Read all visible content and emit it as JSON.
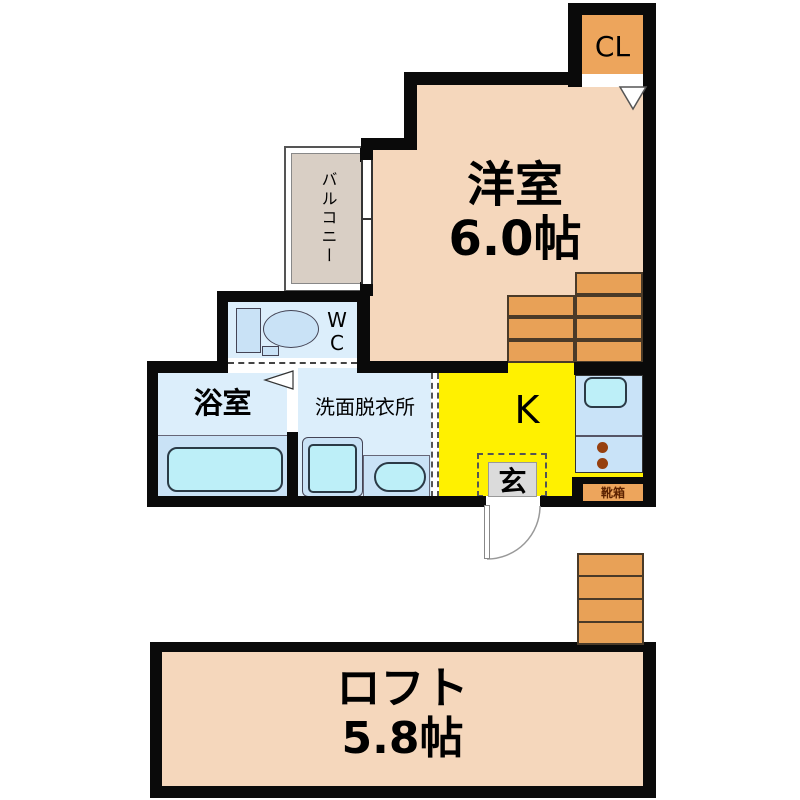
{
  "floorplan": {
    "closet": {
      "label": "CL"
    },
    "main_room": {
      "name": "洋室",
      "area": "6.0帖"
    },
    "balcony": {
      "label": "バルコニー"
    },
    "toilet_room": {
      "lines": [
        "W",
        "C"
      ]
    },
    "bathroom": {
      "label": "浴室"
    },
    "washroom": {
      "label": "洗面脱衣所"
    },
    "kitchen": {
      "label": "K"
    },
    "entrance": {
      "label": "玄"
    },
    "shoe_cabinet": {
      "label": "靴箱"
    },
    "loft": {
      "name": "ロフト",
      "area": "5.8帖"
    },
    "colors": {
      "wall": "#0a0a0a",
      "room_peach": "#F5D7BC",
      "closet_orange": "#EDA55C",
      "stairs_orange": "#E8A157",
      "kitchen_yellow": "#FFF100",
      "room_blue": "#DCEEFB",
      "fixture_blue": "#C9E2F6",
      "fixture_cyan": "#BDEFF8",
      "balcony_gray": "#D9CFC5",
      "entrance_gray": "#DBDBDB",
      "shoe_text": "#5c2200"
    }
  }
}
